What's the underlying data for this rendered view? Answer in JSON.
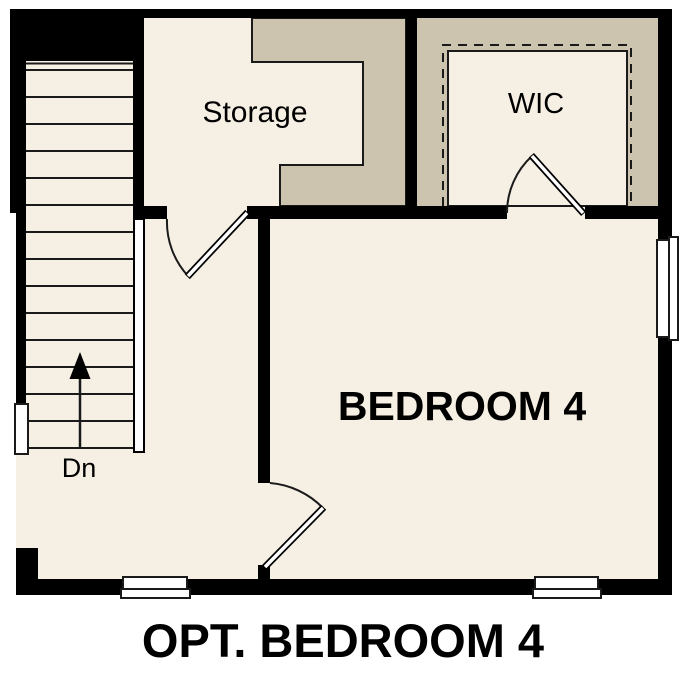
{
  "title": "OPT. BEDROOM 4",
  "rooms": {
    "storage": {
      "label": "Storage"
    },
    "wic": {
      "label": "WIC"
    },
    "bedroom": {
      "label": "BEDROOM 4"
    }
  },
  "stairs": {
    "label": "Dn",
    "direction": "down",
    "tread_count": 15
  },
  "features": {
    "doors": [
      "storage-door",
      "bedroom-door",
      "wic-door"
    ],
    "windows": [
      "left-window",
      "bottom-left-window",
      "bottom-right-window",
      "right-window"
    ]
  },
  "colors": {
    "floor": "#f6f0e4",
    "attic_shade": "#cdc4b0",
    "wall": "#000000",
    "line": "#1a1a1a",
    "window": "#ffffff",
    "background": "#ffffff",
    "text": "#000000"
  }
}
